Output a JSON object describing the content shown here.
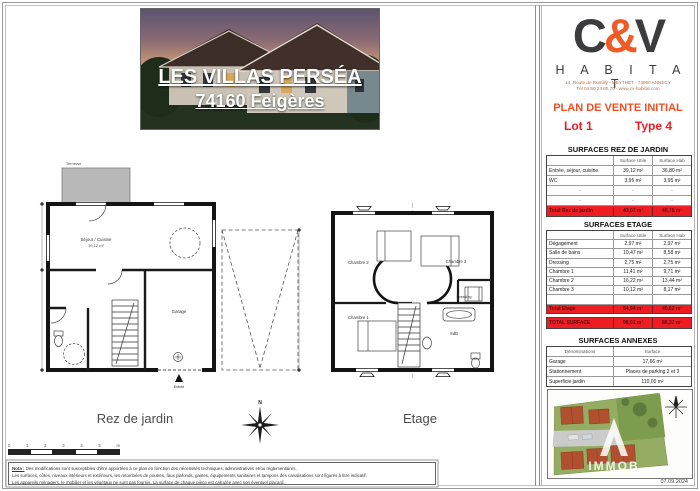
{
  "colors": {
    "accent_red": "#ed1c24",
    "accent_orange": "#f15a24",
    "logo_charcoal": "#3c3c3e",
    "total_row_bg": "#ee1c23",
    "terrace_gray": "#b8b8b8"
  },
  "header_photo": {
    "title": "LES VILLAS PERSÉA",
    "subtitle": "74160 Feigères"
  },
  "brand": {
    "logo_c": "C",
    "logo_amp": "&",
    "logo_v": "V",
    "name": "H A B I T A T",
    "address_line1": "14, Route de Rumilly - MEYTHET - 74960 ANNECY",
    "address_line2": "Tél 04.50.24.60.70 - www.cv-habitat.com"
  },
  "plan_header": {
    "title": "PLAN DE VENTE INITIAL",
    "lot": "Lot 1",
    "type": "Type 4"
  },
  "tables": {
    "rez": {
      "title": "SURFACES REZ DE JARDIN",
      "col_utile": "Surface Utile",
      "col_hab": "Surface Hab",
      "rows": [
        {
          "label": "Entrée, séjour, cuisine.",
          "utile": "39,12 m²",
          "hab": "36,80 m²"
        },
        {
          "label": "WC",
          "utile": "3,95 m²",
          "hab": "3,95 m²"
        },
        {
          "label": "-",
          "utile": "-",
          "hab": "-"
        },
        {
          "label": "-",
          "utile": "-",
          "hab": "-"
        }
      ],
      "total": {
        "label": "Total Rez de jardin",
        "utile": "43,07 m²",
        "hab": "40,75 m²"
      }
    },
    "etage": {
      "title": "SURFACES ETAGE",
      "col_utile": "Surface Utile",
      "col_hab": "Surface Hab",
      "rows": [
        {
          "label": "Dégagement",
          "utile": "2,97 m²",
          "hab": "2,97 m²"
        },
        {
          "label": "Salle de bains",
          "utile": "10,47 m²",
          "hab": "8,58 m²"
        },
        {
          "label": "Dressing",
          "utile": "2,75 m²",
          "hab": "2,75 m²"
        },
        {
          "label": "Chambre 1",
          "utile": "11,41 m²",
          "hab": "9,71 m²"
        },
        {
          "label": "Chambre 2",
          "utile": "16,22 m²",
          "hab": "13,44 m²"
        },
        {
          "label": "Chambre 3",
          "utile": "10,12 m²",
          "hab": "8,17 m²"
        },
        {
          "label": "",
          "utile": "",
          "hab": ""
        }
      ],
      "total": {
        "label": "Total Etage",
        "utile": "54,94 m²",
        "hab": "45,62 m²"
      }
    },
    "total_surface": {
      "label": "TOTAL SURFACE",
      "utile": "98,01 m²",
      "hab": "86,37 m²"
    },
    "annexes": {
      "title": "SURFACES ANNEXES",
      "col_label": "Dénominations",
      "col_value": "Surface",
      "rows": [
        {
          "label": "Garage",
          "value": "17,66 m²"
        },
        {
          "label": "Stationnement",
          "value": "Places de parking 2 et 3"
        },
        {
          "label": "Superficie jardin",
          "value": "110,00 m²"
        }
      ]
    }
  },
  "plans": {
    "captions": {
      "left": "Rez de jardin",
      "right": "Etage"
    },
    "north_label": "N",
    "rez_rooms": {
      "terrasse": "Terrasse",
      "sejour": "Séjour / Cuisine",
      "sejour_area": "39,12 m²",
      "garage": "Garage",
      "entree": "Entrée"
    },
    "etage_rooms": {
      "chambre1": "Chambre 1",
      "chambre2": "Chambre 2",
      "chambre3": "Chambre 3",
      "dressing": "Dressing",
      "sdb": "SdB"
    }
  },
  "scale_bar": {
    "labels": [
      "0",
      "1",
      "2",
      "3",
      "4",
      "5"
    ],
    "unit": "m"
  },
  "site_plan": {
    "watermark": "IMMOB",
    "date": "07.09.2024"
  },
  "footer": {
    "nota_label": "Nota :",
    "nota_line1": "Des modifications sont susceptibles d'être apportées à ce plan en fonction des nécessités techniques, administratives et/ou réglementaires.",
    "nota_line2": "Les surfaces, côtes, niveaux intérieurs et extérieurs, les retombées de poutres, faux plafonds, gaines, équipements sanitaires et tampons des canalisations sont figurés à titre indicatif.",
    "nota_line3": "Les appareils ménagers, le mobilier et les végétaux ne sont pas fournis. La surface de chaque pièce est calculée avec son éventuel placard."
  }
}
